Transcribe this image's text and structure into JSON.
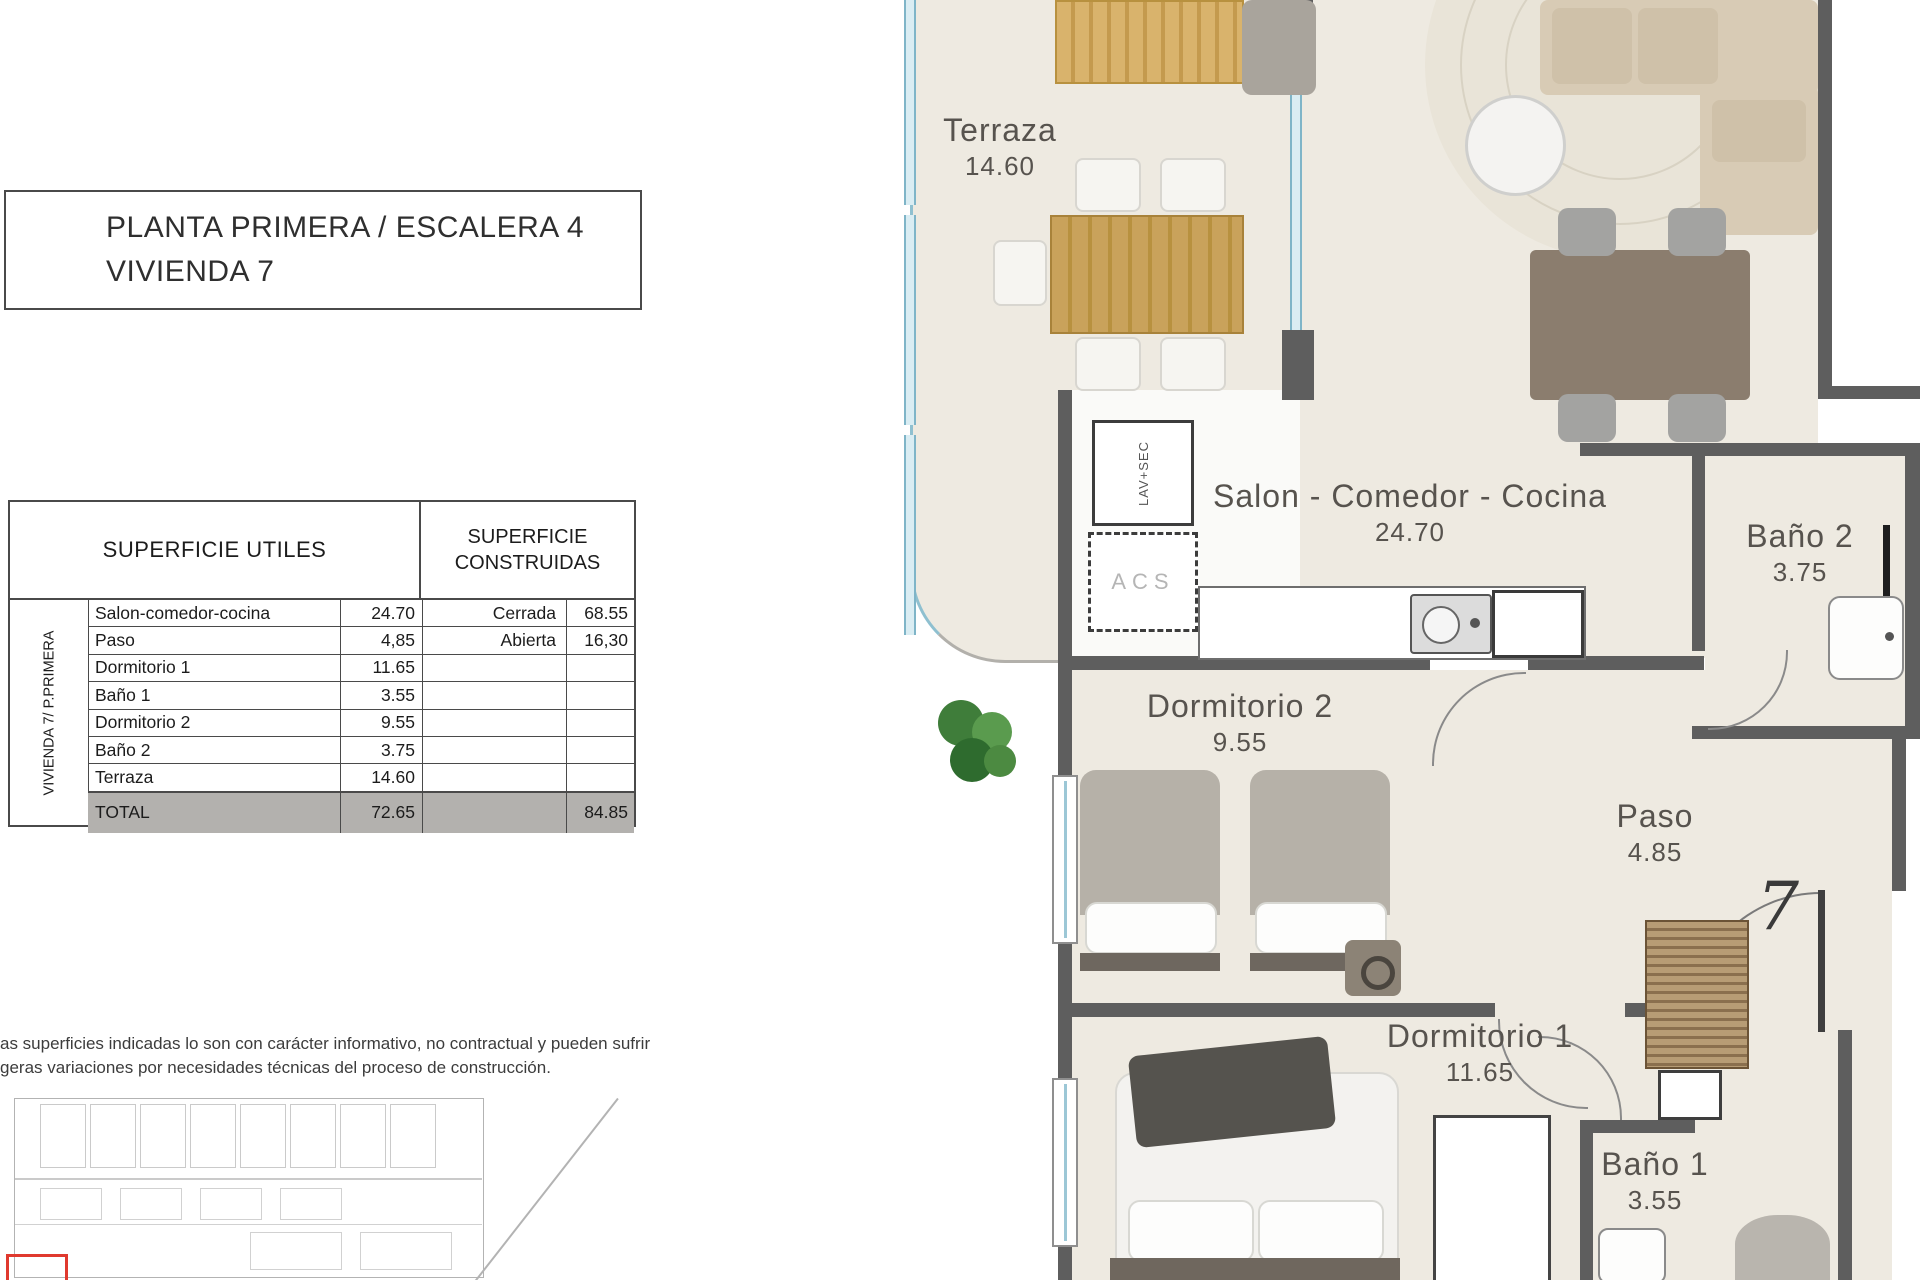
{
  "title": {
    "line1": "PLANTA PRIMERA / ESCALERA 4",
    "line2": "VIVIENDA 7"
  },
  "table": {
    "header_utiles": "SUPERFICIE UTILES",
    "header_construidas_line1": "SUPERFICIE",
    "header_construidas_line2": "CONSTRUIDAS",
    "side_label": "VIVIENDA 7/ P.PRIMERA",
    "rows": [
      {
        "name": "Salon-comedor-cocina",
        "value": "24.70",
        "c_label": "Cerrada",
        "c_value": "68.55"
      },
      {
        "name": "Paso",
        "value": "4,85",
        "c_label": "Abierta",
        "c_value": "16,30"
      },
      {
        "name": "Dormitorio 1",
        "value": "11.65",
        "c_label": "",
        "c_value": ""
      },
      {
        "name": "Baño 1",
        "value": "3.55",
        "c_label": "",
        "c_value": ""
      },
      {
        "name": "Dormitorio 2",
        "value": "9.55",
        "c_label": "",
        "c_value": ""
      },
      {
        "name": "Baño 2",
        "value": "3.75",
        "c_label": "",
        "c_value": ""
      },
      {
        "name": "Terraza",
        "value": "14.60",
        "c_label": "",
        "c_value": ""
      }
    ],
    "total": {
      "name": "TOTAL",
      "value": "72.65",
      "c_value": "84.85"
    }
  },
  "disclaimer": {
    "line1": "as superficies indicadas lo son con carácter informativo, no contractual y pueden sufrir",
    "line2": "geras variaciones por necesidades técnicas del proceso de construcción."
  },
  "plan": {
    "unit_number": "7",
    "closets": {
      "lav": "LAV+SEC",
      "acs": "ACS"
    },
    "rooms": [
      {
        "name": "Terraza",
        "area": "14.60"
      },
      {
        "name": "Salon - Comedor - Cocina",
        "area": "24.70"
      },
      {
        "name": "Baño 2",
        "area": "3.75"
      },
      {
        "name": "Dormitorio 2",
        "area": "9.55"
      },
      {
        "name": "Paso",
        "area": "4.85"
      },
      {
        "name": "Dormitorio 1",
        "area": "11.65"
      },
      {
        "name": "Baño 1",
        "area": "3.55"
      }
    ]
  }
}
